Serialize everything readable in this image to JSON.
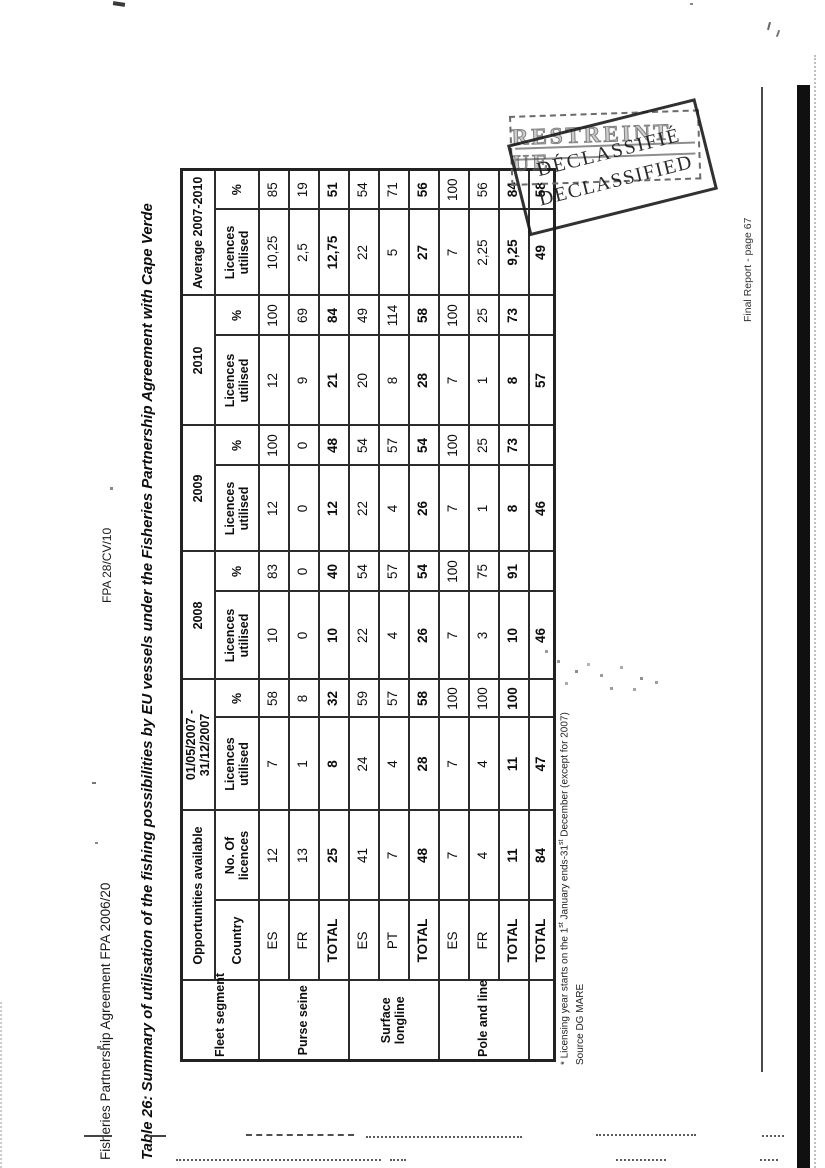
{
  "page": {
    "header_left": "Fisheries Partnership Agreement FPA 2006/20",
    "header_center": "FPA 28/CV/10",
    "title": "Table 26: Summary of utilisation of the fishing possibilities by EU vessels under the Fisheries Partnership Agreement with Cape Verde",
    "footer": "Final Report - page 67"
  },
  "footnote": {
    "pre": "* Licensing year starts on the 1",
    "sup1": "st",
    "mid": " January ends-31",
    "sup2": "st",
    "post": " December (except for 2007)",
    "source": "Source DG MARE"
  },
  "stamps": {
    "restricted": "RESTREINT UE",
    "declassified_fr": "DÉCLASSIFIÉ",
    "declassified_en": "DECLASSIFIED"
  },
  "table": {
    "h1": {
      "fleet": "Fleet segment",
      "opportunities": "Opportunities available",
      "period_2007": "01/05/2007 - 31/12/2007",
      "y2008": "2008",
      "y2009": "2009",
      "y2010": "2010",
      "average": "Average 2007-2010"
    },
    "h2": {
      "country": "Country",
      "no_of_licences": "No. Of licences",
      "licences_utilised": "Licences utilised",
      "percent": "%"
    },
    "groups": [
      "Purse seine",
      "Surface longline",
      "Pole and line"
    ],
    "rows": [
      {
        "country": "ES",
        "v": [
          "12",
          "7",
          "58",
          "10",
          "83",
          "12",
          "100",
          "12",
          "100",
          "10,25",
          "85"
        ]
      },
      {
        "country": "FR",
        "v": [
          "13",
          "1",
          "8",
          "0",
          "0",
          "0",
          "0",
          "9",
          "69",
          "2,5",
          "19"
        ]
      },
      {
        "country": "TOTAL",
        "v": [
          "25",
          "8",
          "32",
          "10",
          "40",
          "12",
          "48",
          "21",
          "84",
          "12,75",
          "51"
        ]
      },
      {
        "country": "ES",
        "v": [
          "41",
          "24",
          "59",
          "22",
          "54",
          "22",
          "54",
          "20",
          "49",
          "22",
          "54"
        ]
      },
      {
        "country": "PT",
        "v": [
          "7",
          "4",
          "57",
          "4",
          "57",
          "4",
          "57",
          "8",
          "114",
          "5",
          "71"
        ]
      },
      {
        "country": "TOTAL",
        "v": [
          "48",
          "28",
          "58",
          "26",
          "54",
          "26",
          "54",
          "28",
          "58",
          "27",
          "56"
        ]
      },
      {
        "country": "ES",
        "v": [
          "7",
          "7",
          "100",
          "7",
          "100",
          "7",
          "100",
          "7",
          "100",
          "7",
          "100"
        ]
      },
      {
        "country": "FR",
        "v": [
          "4",
          "4",
          "100",
          "3",
          "75",
          "1",
          "25",
          "1",
          "25",
          "2,25",
          "56"
        ]
      },
      {
        "country": "TOTAL",
        "v": [
          "11",
          "11",
          "100",
          "10",
          "91",
          "8",
          "73",
          "8",
          "73",
          "9,25",
          "84"
        ]
      },
      {
        "country": "TOTAL",
        "v": [
          "84",
          "47",
          "",
          "46",
          "",
          "46",
          "",
          "57",
          "",
          "49",
          "58"
        ]
      }
    ]
  }
}
